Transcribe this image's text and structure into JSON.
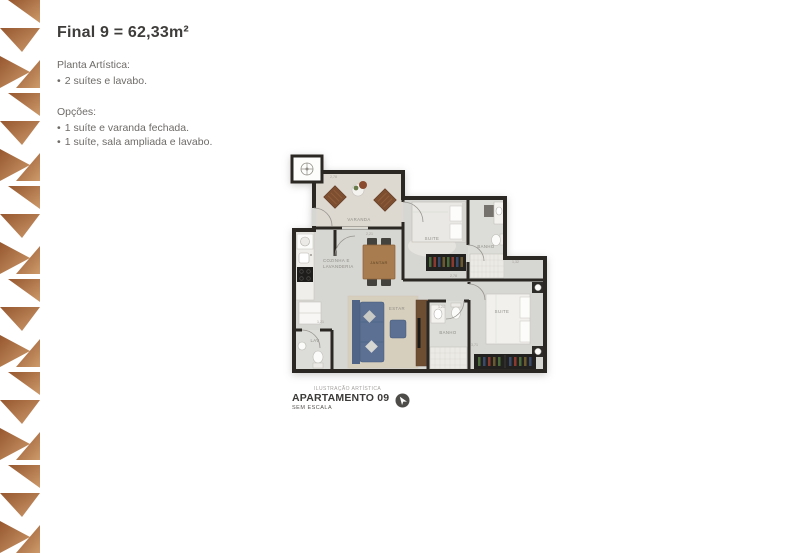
{
  "header": {
    "title": "Final 9 = 62,33m²"
  },
  "specs": {
    "bullet": "•",
    "planta_title": "Planta Artística:",
    "planta_items": [
      "2 suítes e lavabo."
    ],
    "opcoes_title": "Opções:",
    "opcoes_items": [
      "1 suíte e varanda fechada.",
      "1 suíte, sala ampliada e lavabo."
    ]
  },
  "floorplan": {
    "rooms": [
      {
        "label": "VARANDA"
      },
      {
        "label": "SUITE"
      },
      {
        "label": "BANHO"
      },
      {
        "label": "JANTAR"
      },
      {
        "label": "COZINHA E"
      },
      {
        "label": "LAVANDERIA"
      },
      {
        "label": "ESTAR"
      },
      {
        "label": "LAV"
      },
      {
        "label": "BANHO"
      },
      {
        "label": "SUITE"
      }
    ],
    "dimensions": [
      "2,78",
      "2,21",
      "2,78",
      "1,20",
      "3,71",
      "1,32",
      "1,21"
    ],
    "colors": {
      "wall": "#2b2824",
      "floor": "#d6d6d2",
      "varanda_floor": "#ddd9d1",
      "bath_floor": "#dcddd9",
      "sofa": "#5b7093",
      "wood": "#a87c4e",
      "rug": "#d7cfbe",
      "wardrobe": "#22211f"
    }
  },
  "caption": {
    "microtext": "ILUSTRAÇÃO ARTÍSTICA",
    "title": "APARTAMENTO 09",
    "subtitle": "SEM ESCALA"
  },
  "pattern": {
    "copper_dark": "#96572f",
    "copper_light": "#cd9a6b"
  }
}
